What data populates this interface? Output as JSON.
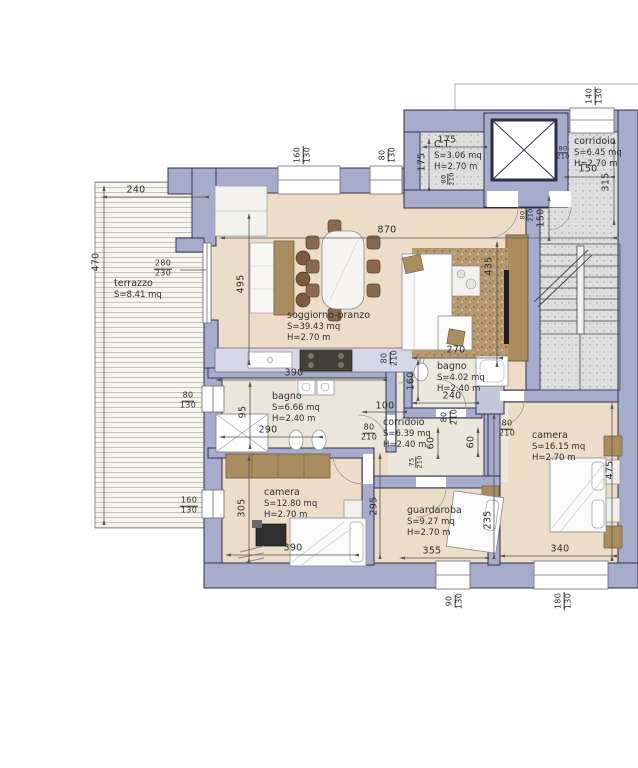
{
  "colors": {
    "wall": "#a7accc",
    "wall_stroke": "#31314a",
    "floor": "#eddcc8",
    "service_floor": "#ebe5da",
    "common_floor": "#dcdcdc",
    "terrace": "#f6f4f0",
    "rug": "#b79a72",
    "wood": "#a98d5f",
    "counter": "#d6d8e6"
  },
  "rooms": {
    "terrazzo": {
      "name": "terrazzo",
      "area": "S=8.41 mq"
    },
    "ct": {
      "name": "C.T.",
      "area": "S=3.06 mq",
      "height": "H=2.70 m"
    },
    "corridoio_scale": {
      "name": "corridoio",
      "area": "S=6.45 mq",
      "height": "H=2.70 m"
    },
    "soggiorno": {
      "name": "soggiorno-pranzo",
      "area": "S=39.43 mq",
      "height": "H=2.70 m"
    },
    "bagno1": {
      "name": "bagno",
      "area": "S=6.66 mq",
      "height": "H=2.40 m"
    },
    "bagno2": {
      "name": "bagno",
      "area": "S=4.02 mq",
      "height": "H=2.40 m"
    },
    "corridoio": {
      "name": "corridoio",
      "area": "S=6.39 mq",
      "height": "H=2.40 m"
    },
    "camera_ovest": {
      "name": "camera",
      "area": "S=12.80 mq",
      "height": "H=2.70 m"
    },
    "camera_est": {
      "name": "camera",
      "area": "S=16.15 mq",
      "height": "H=2.70 m"
    },
    "guardaroba": {
      "name": "guardaroba",
      "area": "S=9.27 mq",
      "height": "H=2.70 m"
    }
  },
  "dimensions": {
    "d240": "240",
    "d470": "470",
    "d495": "495",
    "d870": "870",
    "d175a": "175",
    "d175b": "175",
    "d150_corridoio": "150",
    "d315": "315",
    "d150_scala": "150",
    "d435": "435",
    "d390_bagno": "390",
    "d95": "95",
    "d290": "290",
    "d100": "100",
    "d160_bagno": "160",
    "d60_corridoio": "60",
    "d60_camera": "60",
    "d270": "270",
    "d240_bagno": "240",
    "d305": "305",
    "d390_camera": "390",
    "d295": "295",
    "d355": "355",
    "d235": "235",
    "d340": "340",
    "d475": "475"
  },
  "openings": {
    "w160_130_top": {
      "num": "160",
      "den": "130"
    },
    "w80_130_top": {
      "num": "80",
      "den": "130"
    },
    "w140_130": {
      "num": "140",
      "den": "130"
    },
    "w280_230": {
      "num": "280",
      "den": "230"
    },
    "w80_130_left": {
      "num": "80",
      "den": "130"
    },
    "w160_130_left": {
      "num": "160",
      "den": "130"
    },
    "w90_130_bottom": {
      "num": "90",
      "den": "130"
    },
    "w180_130_bottom": {
      "num": "180",
      "den": "130"
    },
    "d80_210_ct": {
      "num": "80",
      "den": "210"
    },
    "d80_210_ingresso": {
      "num": "80",
      "den": "210"
    },
    "d80_210_scala": {
      "num": "80",
      "den": "210"
    },
    "d80_210_soggiorno": {
      "num": "80",
      "den": "210"
    },
    "d80_210_bagno1": {
      "num": "80",
      "den": "210"
    },
    "d80_210_bagno2": {
      "num": "80",
      "den": "210"
    },
    "d80_210_camera": {
      "num": "80",
      "den": "210"
    },
    "d75_210_guardaroba": {
      "num": "75",
      "den": "210"
    }
  }
}
